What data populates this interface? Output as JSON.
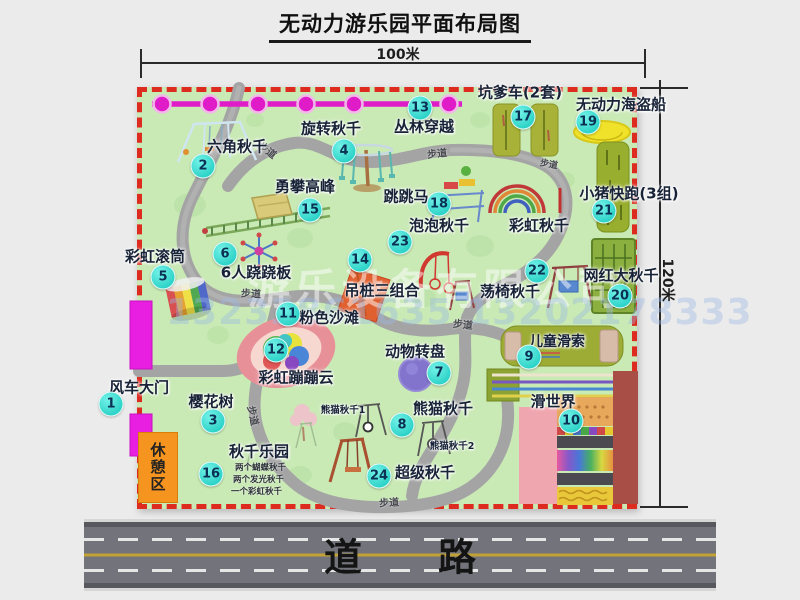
{
  "title": "无动力游乐园平面布局图",
  "dimensions": {
    "width_label": "100米",
    "height_label": "120米"
  },
  "road": {
    "label": "道　　路"
  },
  "rest_area": {
    "label": "休憩区"
  },
  "footpath": "步道",
  "watermark": {
    "company": "游乐设备有限公司",
    "phone": "13233861635 13202178333"
  },
  "colors": {
    "park_green": "#c9e9b5",
    "border_red": "#dd2b20",
    "badge_cyan": "#2ed3c8",
    "zipline_magenta": "#e11cc9",
    "gate_magenta": "#e81ee0",
    "rest_orange": "#f5941e",
    "road_gray": "#73737b"
  },
  "attractions": [
    {
      "num": "1",
      "name": "风车大门"
    },
    {
      "num": "2",
      "name": "六角秋千"
    },
    {
      "num": "3",
      "name": "樱花树"
    },
    {
      "num": "4",
      "name": "旋转秋千"
    },
    {
      "num": "5",
      "name": "彩虹滚筒"
    },
    {
      "num": "6",
      "name": "6人跷跷板"
    },
    {
      "num": "7",
      "name": "动物转盘"
    },
    {
      "num": "8",
      "name": "熊猫秋千"
    },
    {
      "num": "9",
      "name": "儿童滑索"
    },
    {
      "num": "10",
      "name": "滑世界"
    },
    {
      "num": "11",
      "name": "粉色沙滩"
    },
    {
      "num": "12",
      "name": "彩虹蹦蹦云"
    },
    {
      "num": "13",
      "name": "丛林穿越"
    },
    {
      "num": "14",
      "name": "吊桩三组合"
    },
    {
      "num": "15",
      "name": "勇攀高峰"
    },
    {
      "num": "16",
      "name": "秋千乐园"
    },
    {
      "num": "17",
      "name": "坑爹车(2套)"
    },
    {
      "num": "18",
      "name": "跳跳马"
    },
    {
      "num": "19",
      "name": "无动力海盗船"
    },
    {
      "num": "20",
      "name": "网红大秋千"
    },
    {
      "num": "21",
      "name": "小猪快跑(3组)"
    },
    {
      "num": "22",
      "name": "荡椅秋千"
    },
    {
      "num": "23",
      "name": "泡泡秋千"
    },
    {
      "num": "24",
      "name": "超级秋千"
    }
  ],
  "other_labels": {
    "rainbow_swing": "彩虹秋千",
    "panda_swing_1": "熊猫秋千1",
    "panda_swing_2": "熊猫秋千2",
    "swing_park_notes": [
      "两个蝴蝶秋千",
      "两个发光秋千",
      "一个彩虹秋千"
    ]
  }
}
